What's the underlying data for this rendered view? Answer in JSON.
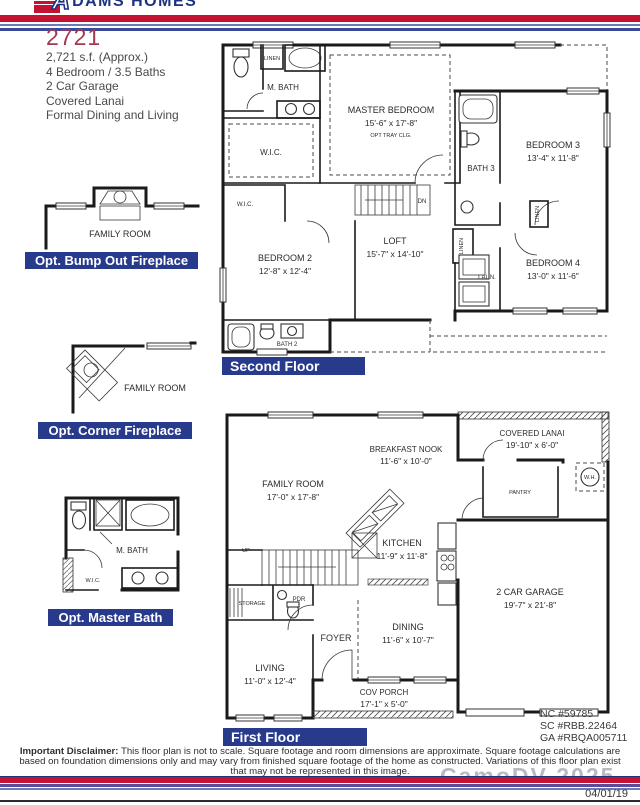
{
  "header": {
    "brand_initial": "A",
    "brand_rest": "DAMS HOMES"
  },
  "title": {
    "model": "2721",
    "specs": [
      "2,721 s.f. (Approx.)",
      "4 Bedroom / 3.5 Baths",
      "2 Car Garage",
      "Covered Lanai",
      "Formal Dining and Living"
    ]
  },
  "options": [
    {
      "label": "Opt. Bump Out Fireplace",
      "room_label": "FAMILY ROOM"
    },
    {
      "label": "Opt. Corner Fireplace",
      "room_label": "FAMILY ROOM"
    },
    {
      "label": "Opt. Master Bath",
      "mbath_label": "M. BATH",
      "wic_label": "W.I.C."
    }
  ],
  "second_floor": {
    "section_label": "Second Floor",
    "rooms": {
      "mbath": "M. BATH",
      "linen_top": "LINEN",
      "master_name": "MASTER BEDROOM",
      "master_dims": "15'-6\" x 17'-8\"",
      "master_note": "OPT TRAY CLG.",
      "wic_large": "W.I.C.",
      "wic_small": "W.I.C.",
      "dn": "DN",
      "bath3": "BATH 3",
      "bed3_name": "BEDROOM 3",
      "bed3_dims": "13'-4\" x 11'-8\"",
      "linen_hall_a": "LINEN",
      "linen_hall_b": "LINEN",
      "bed2_name": "BEDROOM 2",
      "bed2_dims": "12'-8\" x 12'-4\"",
      "loft_name": "LOFT",
      "loft_dims": "15'-7\" x 14'-10\"",
      "laun": "LAUN.",
      "bed4_name": "BEDROOM 4",
      "bed4_dims": "13'-0\" x 11'-6\"",
      "bath2": "BATH 2"
    }
  },
  "first_floor": {
    "section_label": "First Floor",
    "rooms": {
      "family_name": "FAMILY ROOM",
      "family_dims": "17'-0\" x 17'-8\"",
      "nook_name": "BREAKFAST NOOK",
      "nook_dims": "11'-6\" x 10'-0\"",
      "lanai_name": "COVERED LANAI",
      "lanai_dims": "19'-10\" x 6'-0\"",
      "pantry": "PANTRY",
      "wh": "W.H.",
      "kitchen_name": "KITCHEN",
      "kitchen_dims": "11'-9\" x 11'-8\"",
      "garage_name": "2 CAR GARAGE",
      "garage_dims": "19'-7\" x 21'-8\"",
      "storage": "STORAGE",
      "pdr": "PDR",
      "foyer": "FOYER",
      "up": "UP",
      "dining_name": "DINING",
      "dining_dims": "11'-6\" x 10'-7\"",
      "living_name": "LIVING",
      "living_dims": "11'-0\" x 12'-4\"",
      "porch_name": "COV PORCH",
      "porch_dims": "17'-1\" x 5'-0\""
    }
  },
  "licenses": [
    "NC #59785",
    "SC #RBB.22464",
    "GA #RBQA005711"
  ],
  "footer": {
    "disclaimer_label": "Important Disclaimer:",
    "disclaimer_text": "This floor plan is not to scale. Square footage and room dimensions are approximate. Square footage calculations are based on foundation dimensions only and may vary from finished square footage of the home as constructed. Variations of this floor plan exist that may not be represented in this image.",
    "follow_us": "Follow Us:",
    "website": "or http://www.adamshomes.com",
    "date": "04/01/19",
    "watermark": "CamoDV 2025",
    "social": [
      {
        "glyph": "f"
      },
      {
        "glyph": "t"
      },
      {
        "glyph": "in"
      },
      {
        "glyph": "p"
      },
      {
        "glyph": "▶"
      },
      {
        "glyph": "h"
      }
    ]
  },
  "colors": {
    "brand_blue": "#1b3281",
    "brand_red": "#c41230",
    "navy_bar": "#283a8c",
    "title_red": "#a13a4e"
  }
}
